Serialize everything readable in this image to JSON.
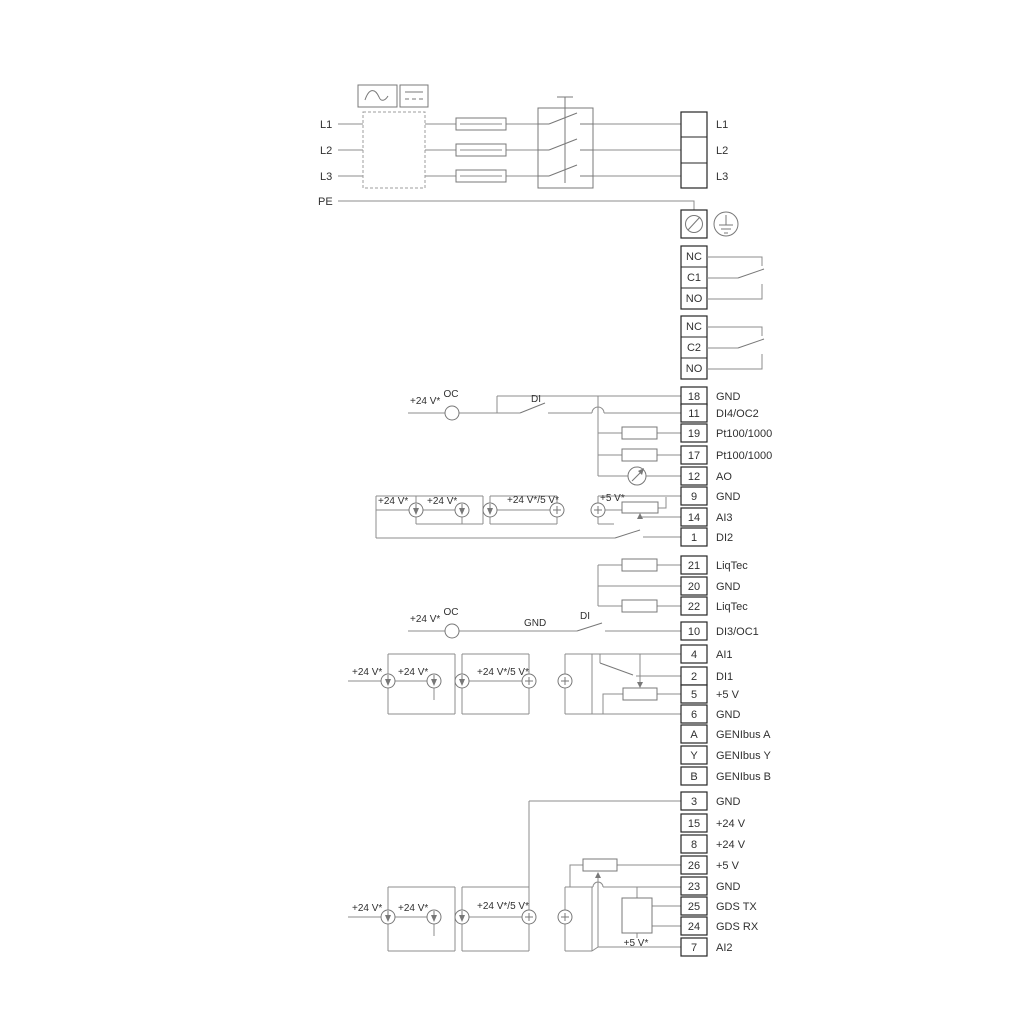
{
  "power": {
    "inputs": [
      "L1",
      "L2",
      "L3",
      "PE"
    ],
    "outputs": [
      "L1",
      "L2",
      "L3"
    ]
  },
  "relays": {
    "r1": [
      "NC",
      "C1",
      "NO"
    ],
    "r2": [
      "NC",
      "C2",
      "NO"
    ]
  },
  "terminals": {
    "io_top": [
      {
        "num": "18",
        "label": "GND"
      },
      {
        "num": "11",
        "label": "DI4/OC2"
      },
      {
        "num": "19",
        "label": "Pt100/1000"
      },
      {
        "num": "17",
        "label": "Pt100/1000"
      },
      {
        "num": "12",
        "label": "AO"
      },
      {
        "num": "9",
        "label": "GND"
      },
      {
        "num": "14",
        "label": "AI3"
      },
      {
        "num": "1",
        "label": "DI2"
      }
    ],
    "liqtec": [
      {
        "num": "21",
        "label": "LiqTec"
      },
      {
        "num": "20",
        "label": "GND"
      },
      {
        "num": "22",
        "label": "LiqTec"
      }
    ],
    "io_mid": [
      {
        "num": "10",
        "label": "DI3/OC1"
      },
      {
        "num": "4",
        "label": "AI1"
      },
      {
        "num": "2",
        "label": "DI1"
      },
      {
        "num": "5",
        "label": "+5 V"
      },
      {
        "num": "6",
        "label": "GND"
      },
      {
        "num": "A",
        "label": "GENIbus A"
      },
      {
        "num": "Y",
        "label": "GENIbus Y"
      },
      {
        "num": "B",
        "label": "GENIbus B"
      }
    ],
    "io_bot": [
      {
        "num": "3",
        "label": "GND"
      },
      {
        "num": "15",
        "label": "+24 V"
      },
      {
        "num": "8",
        "label": "+24 V"
      },
      {
        "num": "26",
        "label": "+5 V"
      },
      {
        "num": "23",
        "label": "GND"
      },
      {
        "num": "25",
        "label": "GDS TX"
      },
      {
        "num": "24",
        "label": "GDS RX"
      },
      {
        "num": "7",
        "label": "AI2"
      }
    ]
  },
  "annotations": {
    "plus24": "+24 V*",
    "plus24or5": "+24 V*/5 V*",
    "plus5": "+5 V*",
    "oc": "OC",
    "di": "DI",
    "gnd": "GND"
  },
  "colors": {
    "wire": "#8c8c8c",
    "component": "#787878",
    "terminal_border": "#262626",
    "text": "#303030"
  }
}
